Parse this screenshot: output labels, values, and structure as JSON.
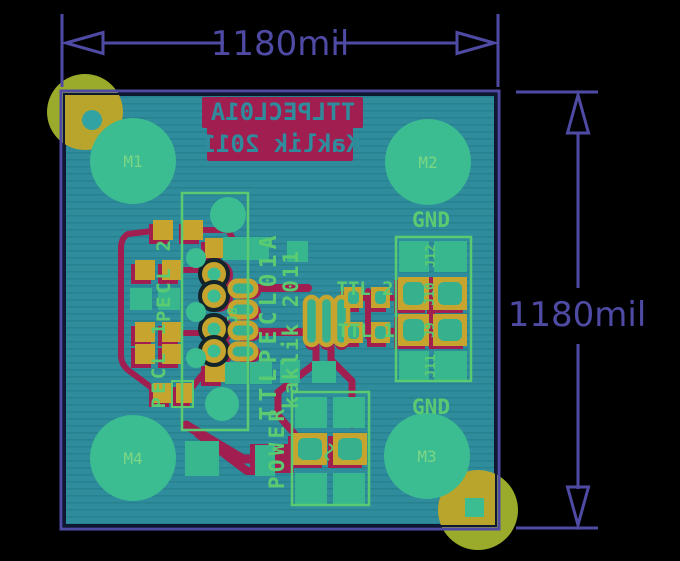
{
  "view": {
    "background": "#000000",
    "description": "PCB bottom-copper layout render with dimension annotations"
  },
  "dims": {
    "top_label": "1180mil",
    "right_label": "1180mil",
    "color": "#4f4ba5"
  },
  "colors": {
    "board": "#2e8c9c",
    "board_stripe": "#28818f",
    "outline_purple": "#4f4ba5",
    "copper_pour": "#3cbc91",
    "pad_yellow": "#c7a42e",
    "trace_crimson": "#a01e50",
    "silkscreen_green": "#5bcb71",
    "drill_ring_outer": "#9aaa2b",
    "drill_ring_inner": "#b9a52c"
  },
  "silk": {
    "mirror_line1": "TTLPECL01A",
    "mirror_line2": "Kaklik 2011",
    "ic_name": "TTLPECL01A",
    "author": "kaklik 2011",
    "power": "POWER",
    "gnd_top": "GND",
    "gnd_bottom": "GND",
    "ttl2": "TTL 2",
    "ttl1": "TTL 1",
    "pecl2": "PECL 2",
    "pecl1": "PECL 1",
    "j8": "J8",
    "j9": "J9",
    "j10": "J10",
    "j11": "J11",
    "j12": "J12"
  },
  "mount_holes": {
    "m1": "M1",
    "m2": "M2",
    "m3": "M3",
    "m4": "M4"
  }
}
